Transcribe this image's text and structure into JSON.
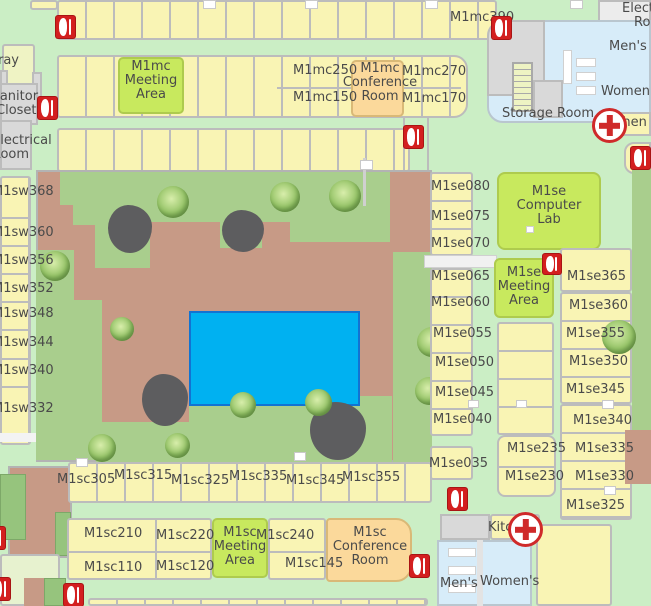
{
  "rooms_mc": {
    "r390": "M1mc390",
    "r250": "M1mc250",
    "r150": "M1mc150",
    "r270": "M1mc270",
    "r170": "M1mc170",
    "meeting": "M1mc\nMeeting\nArea",
    "conference": "M1mc\nConference\nRoom"
  },
  "rooms_sw": {
    "r368": "M1sw368",
    "r360": "M1sw360",
    "r356": "M1sw356",
    "r352": "M1sw352",
    "r348": "M1sw348",
    "r344": "M1sw344",
    "r340": "M1sw340",
    "r332": "M1sw332"
  },
  "rooms_se": {
    "r080": "M1se080",
    "r075": "M1se075",
    "r070": "M1se070",
    "r065": "M1se065",
    "r060": "M1se060",
    "r055": "M1se055",
    "r050": "M1se050",
    "r045": "M1se045",
    "r040": "M1se040",
    "r035": "M1se035",
    "computer_lab": "M1se\nComputer\nLab",
    "meeting": "M1se\nMeeting\nArea",
    "r365": "M1se365",
    "r360": "M1se360",
    "r355": "M1se355",
    "r350": "M1se350",
    "r345": "M1se345",
    "r340": "M1se340",
    "r335": "M1se335",
    "r330": "M1se330",
    "r325": "M1se325",
    "r235": "M1se235",
    "r230": "M1se230"
  },
  "rooms_sc": {
    "r305": "M1sc305",
    "r315": "M1sc315",
    "r325": "M1sc325",
    "r335": "M1sc335",
    "r345": "M1sc345",
    "r355": "M1sc355",
    "r210": "M1sc210",
    "r220": "M1sc220",
    "r110": "M1sc110",
    "r120": "M1sc120",
    "r240": "M1sc240",
    "r145": "M1sc145",
    "meeting": "M1sc\nMeeting\nArea",
    "conference": "M1sc\nConference\nRoom"
  },
  "facilities": {
    "storage": "Storage Room",
    "kitchen_top": "Kitchen",
    "kitchen_bottom": "Kitchen",
    "mens_top": "Men's",
    "womens_top": "Women's",
    "mens_bottom": "Men's",
    "womens_bottom": "Women's",
    "janitor": "Janitor\nCloset",
    "electrical": "Electrical\nRoom",
    "elect_partial": "Elect",
    "roo_partial": "Roo",
    "ray_partial": "ray"
  },
  "icons": {
    "fire_extinguisher": "fire-extinguisher-icon",
    "first_aid": "first-aid-cross-icon",
    "stairs": "stairs-icon",
    "tree": "tree-icon",
    "rock": "rock-icon"
  },
  "colors": {
    "corridor": "#cbeec5",
    "room_yellow": "#f9f4b4",
    "meeting_green": "#c8e95e",
    "conference_orange": "#fbd99b",
    "courtyard_brown": "#c79a86",
    "grass_green": "#a9ce8d",
    "pool_blue": "#00b1f1",
    "restroom_blue": "#d7ecf9",
    "utility_gray": "#d9d9d9",
    "wall_gray": "#bcbcbc",
    "extinguisher_red": "#d31f1f",
    "first_aid_red": "#cf2a2a",
    "label_text": "#4a4a4a"
  }
}
